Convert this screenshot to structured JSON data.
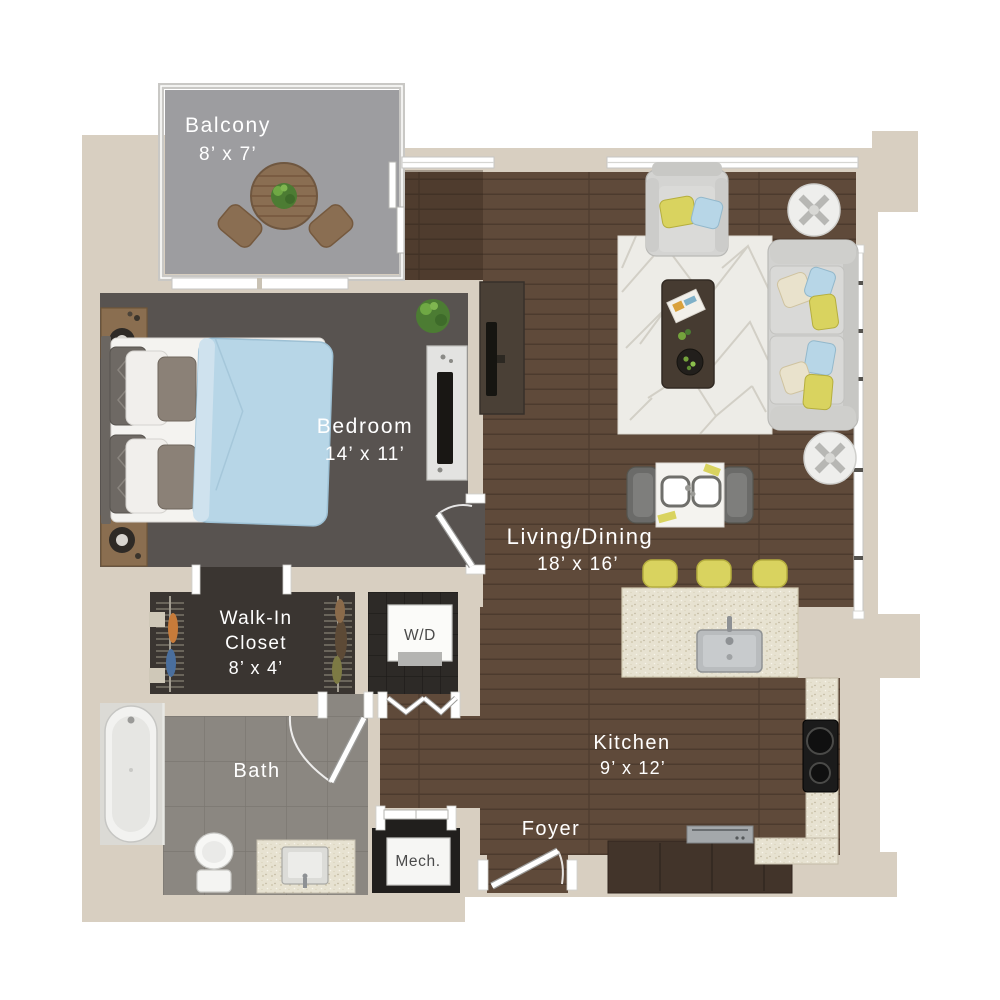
{
  "floorplan": {
    "rooms": {
      "balcony": {
        "name": "Balcony",
        "dims": "8’ x 7’"
      },
      "bedroom": {
        "name": "Bedroom",
        "dims": "14’ x 11’"
      },
      "walk_in_closet": {
        "line1": "Walk-In",
        "line2": "Closet",
        "dims": "8’ x 4’"
      },
      "washer_dryer": {
        "name": "W/D"
      },
      "bath": {
        "name": "Bath"
      },
      "mech": {
        "name": "Mech."
      },
      "foyer": {
        "name": "Foyer"
      },
      "kitchen": {
        "name": "Kitchen",
        "dims": "9’ x 12’"
      },
      "living_dining": {
        "name": "Living/Dining",
        "dims": "18’ x 16’"
      }
    },
    "colors": {
      "background": "#ffffff",
      "wall": "#d8cfc1",
      "balcony_floor": "#9d9da0",
      "bedroom_carpet": "#585350",
      "closet_floor": "#3a3531",
      "wd_floor": "#2d2a27",
      "mech_floor": "#211f1d",
      "bath_tile": "#8b8781",
      "wood_floor": "#5f4a3a",
      "counter_speckle": "#e7e2d1",
      "cabinet_dark": "#42342a",
      "accent_yellow": "#d9d35f",
      "accent_blue": "#b7d6e7",
      "sofa_gray": "#d2d2d0",
      "rug": "#edece7",
      "outdoor_wood": "#8a6e52",
      "label_light": "#ffffff",
      "label_dark": "#4a4a4a"
    }
  }
}
